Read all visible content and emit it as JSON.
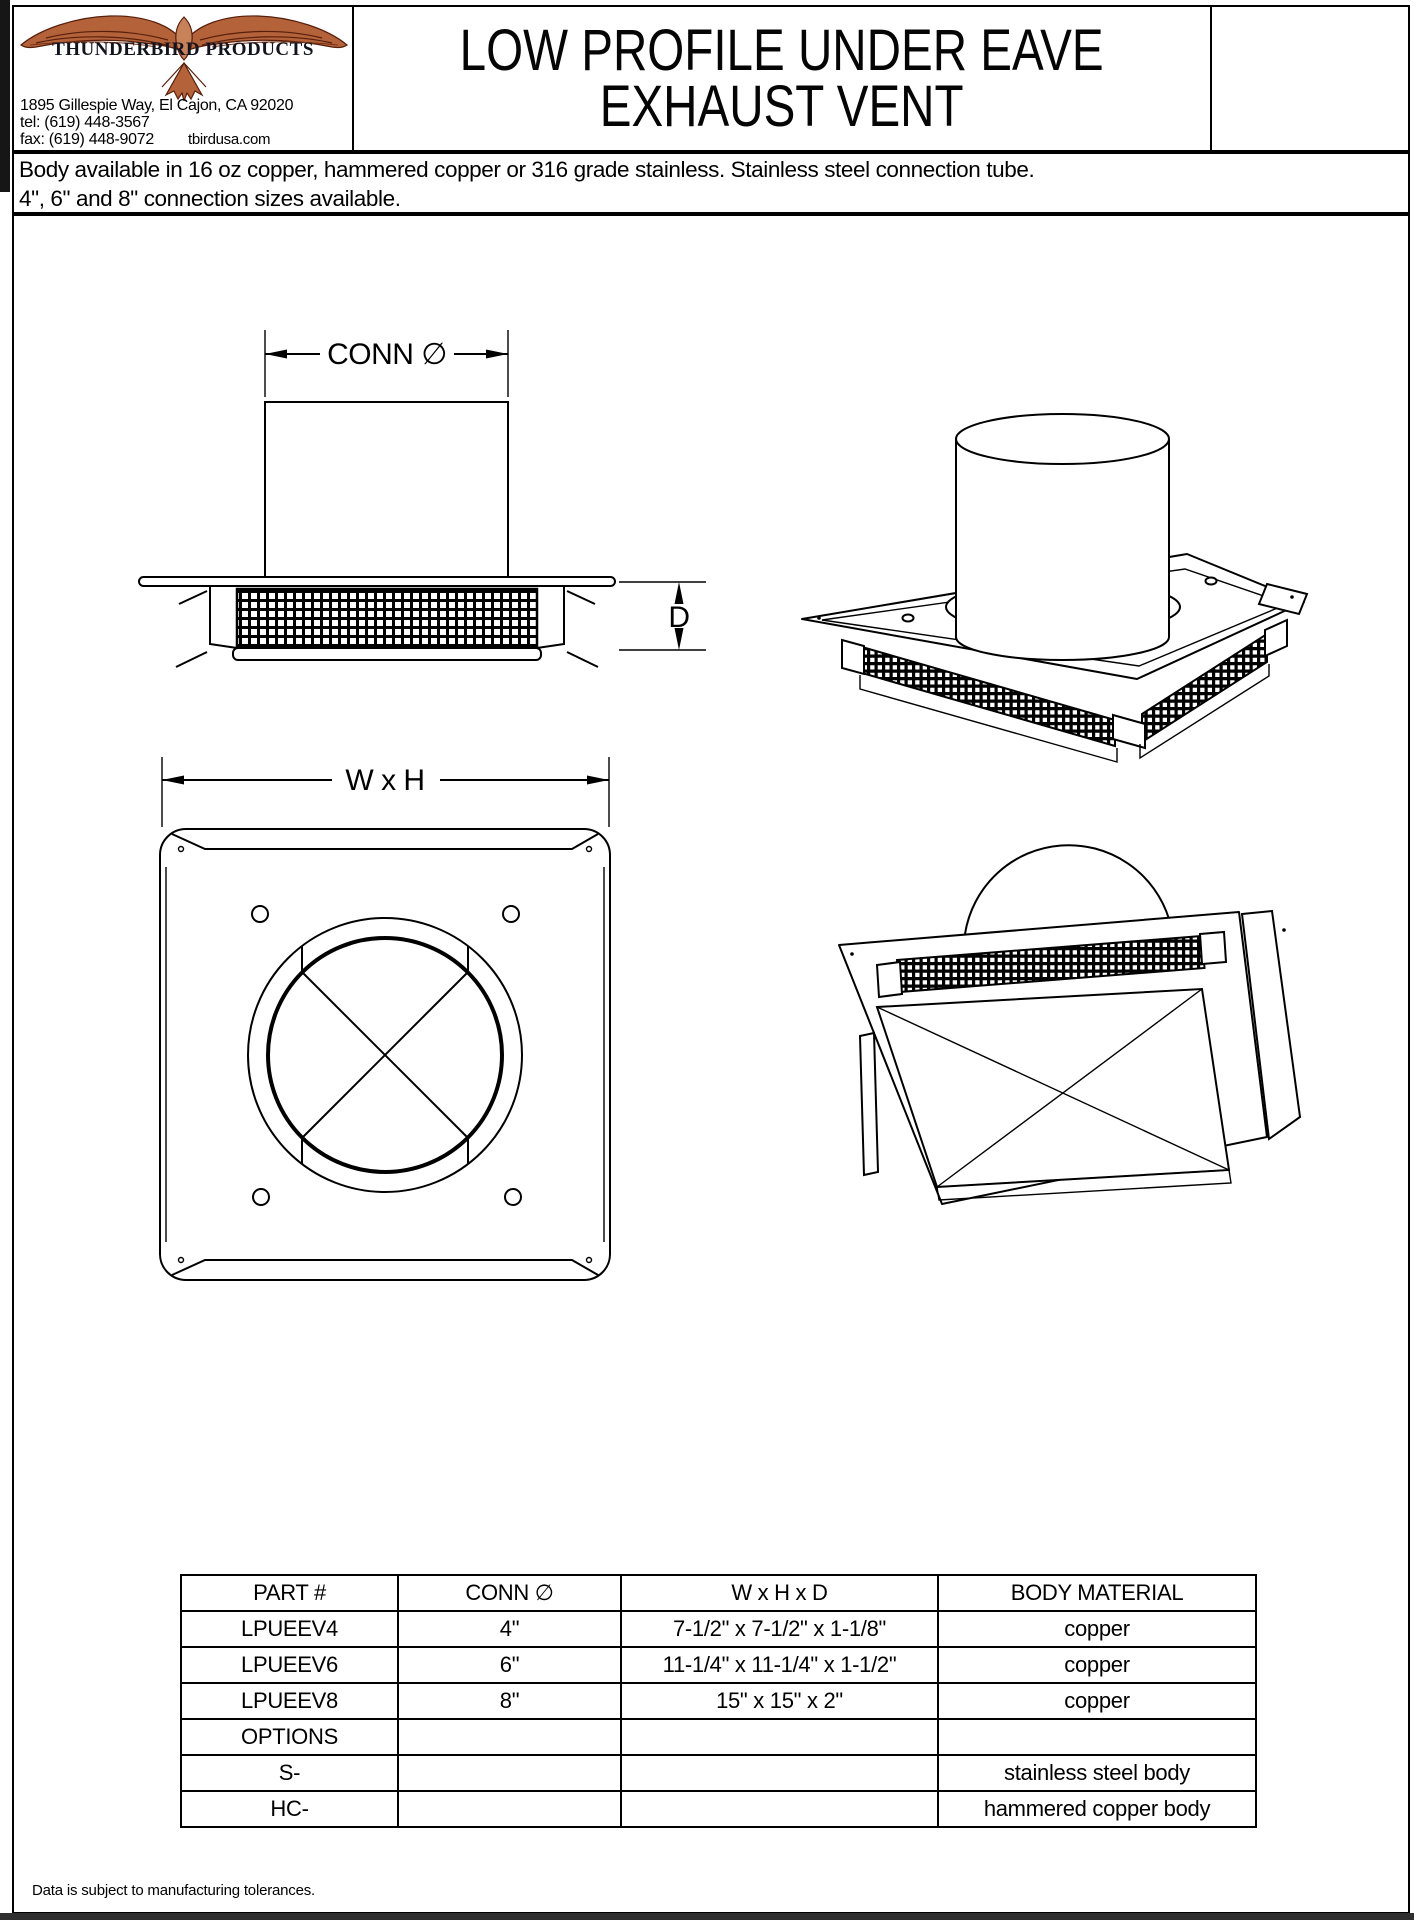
{
  "header": {
    "company_name": "THUNDERBIRD PRODUCTS",
    "address": "1895 Gillespie Way,  El Cajon,  CA 92020",
    "tel": "tel:  (619) 448-3567",
    "fax": "fax: (619) 448-9072",
    "website": "tbirdusa.com",
    "title_line1": "LOW PROFILE UNDER EAVE",
    "title_line2": "EXHAUST VENT"
  },
  "description": {
    "line1": "Body available in 16 oz copper, hammered copper or 316 grade stainless. Stainless steel connection tube.",
    "line2": "4\", 6\" and 8\" connection sizes available."
  },
  "drawing": {
    "connection_diameter": "CONN ∅",
    "depth": "D",
    "width_height": "W x H"
  },
  "table": {
    "headers": [
      "PART #",
      "CONN ∅",
      "W x H x D",
      "BODY MATERIAL"
    ],
    "rows": [
      [
        "LPUEEV4",
        "4\"",
        "7-1/2\" x 7-1/2\" x 1-1/8\"",
        "copper"
      ],
      [
        "LPUEEV6",
        "6\"",
        "11-1/4\" x 11-1/4\" x 1-1/2\"",
        "copper"
      ],
      [
        "LPUEEV8",
        "8\"",
        "15\" x 15\" x 2\"",
        "copper"
      ],
      [
        "OPTIONS",
        "",
        "",
        ""
      ],
      [
        "S-",
        "",
        "",
        "stainless steel body"
      ],
      [
        "HC-",
        "",
        "",
        "hammered copper body"
      ]
    ]
  },
  "footer": {
    "note": "Data is subject to manufacturing tolerances."
  },
  "colors": {
    "copper": "#b4623a",
    "copper_light": "#c8825a",
    "copper_dark": "#571f0c",
    "ink": "#000000"
  }
}
